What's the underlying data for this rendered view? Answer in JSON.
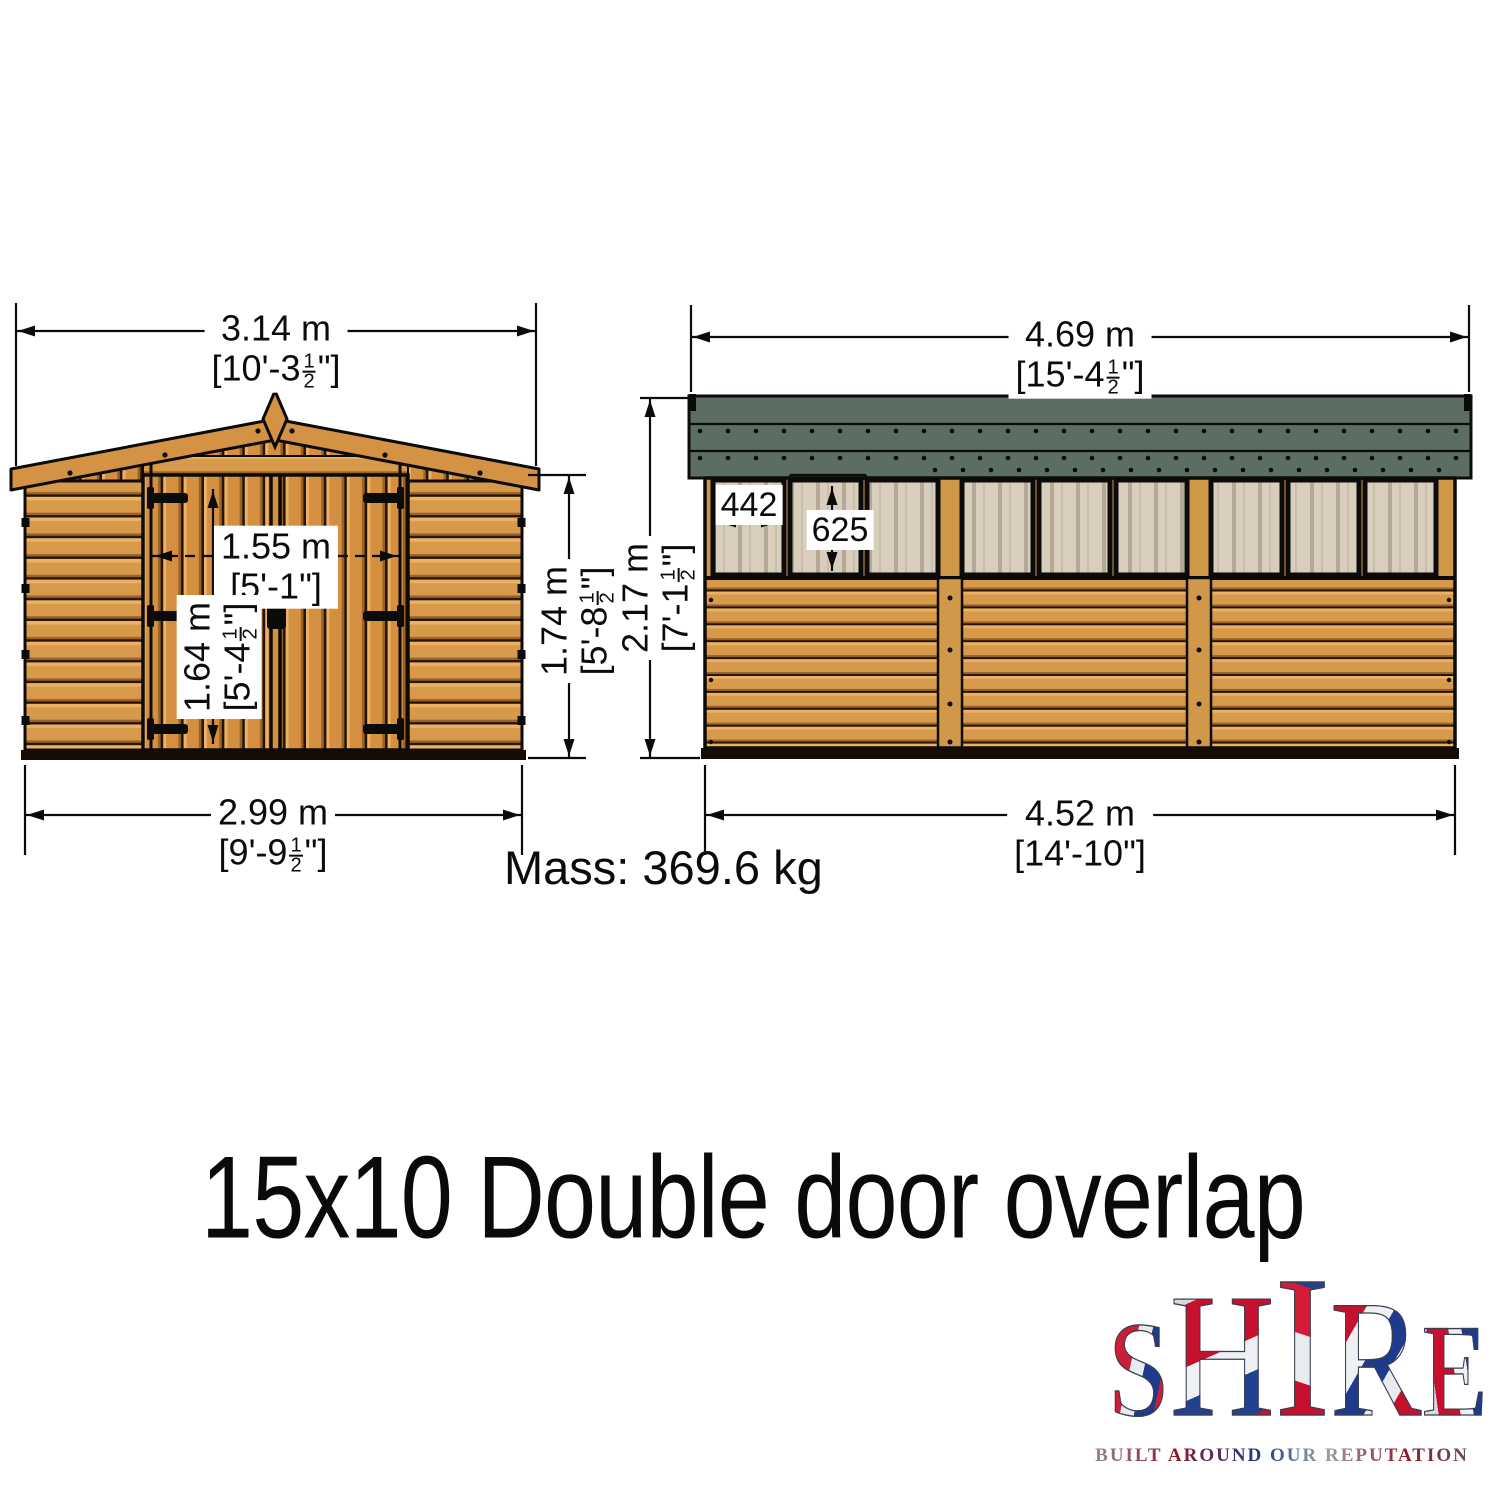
{
  "title": "15x10 Double door overlap",
  "mass_label": "Mass: 369.6 kg",
  "dimensions": {
    "front_overall_width": {
      "metric": "3.14 m",
      "imp_pre": "[10'-3",
      "frac_num": "1",
      "frac_den": "2",
      "imp_post": "\"]"
    },
    "front_base_width": {
      "metric": "2.99 m",
      "imp_pre": "[9'-9",
      "frac_num": "1",
      "frac_den": "2",
      "imp_post": "\"]"
    },
    "door_width": {
      "metric": "1.55 m",
      "imp_pre": "[5'-1\"]",
      "frac_num": "",
      "frac_den": "",
      "imp_post": ""
    },
    "door_height": {
      "metric": "1.64 m",
      "imp_pre": "[5'-4",
      "frac_num": "1",
      "frac_den": "2",
      "imp_post": "\"]"
    },
    "front_eaves_height": {
      "metric": "1.74 m",
      "imp_pre": "[5'-8",
      "frac_num": "1",
      "frac_den": "2",
      "imp_post": "\"]"
    },
    "side_overall_width": {
      "metric": "4.69 m",
      "imp_pre": "[15'-4",
      "frac_num": "1",
      "frac_den": "2",
      "imp_post": "\"]"
    },
    "side_base_width": {
      "metric": "4.52 m",
      "imp_pre": "[14'-10\"]",
      "frac_num": "",
      "frac_den": "",
      "imp_post": ""
    },
    "side_ridge_height": {
      "metric": "2.17 m",
      "imp_pre": "[7'-1",
      "frac_num": "1",
      "frac_den": "2",
      "imp_post": "\"]"
    },
    "window_width_mm": "442",
    "window_height_mm": "625"
  },
  "logo": {
    "letters": [
      "S",
      "H",
      "I",
      "R",
      "E"
    ],
    "tagline": "BUILT AROUND OUR REPUTATION"
  },
  "colors": {
    "wood_face": "#d49344",
    "wood_light": "#ecb163",
    "wood_shadow": "#9a6325",
    "plank_gap": "#241406",
    "roof_felt_green": "#5c6e63",
    "window_glass": "#d9cdbc",
    "line_black": "#0b0b0b",
    "union_red": "#c8102e",
    "union_blue": "#1e3a8c",
    "union_silver": "#ccd2da"
  }
}
